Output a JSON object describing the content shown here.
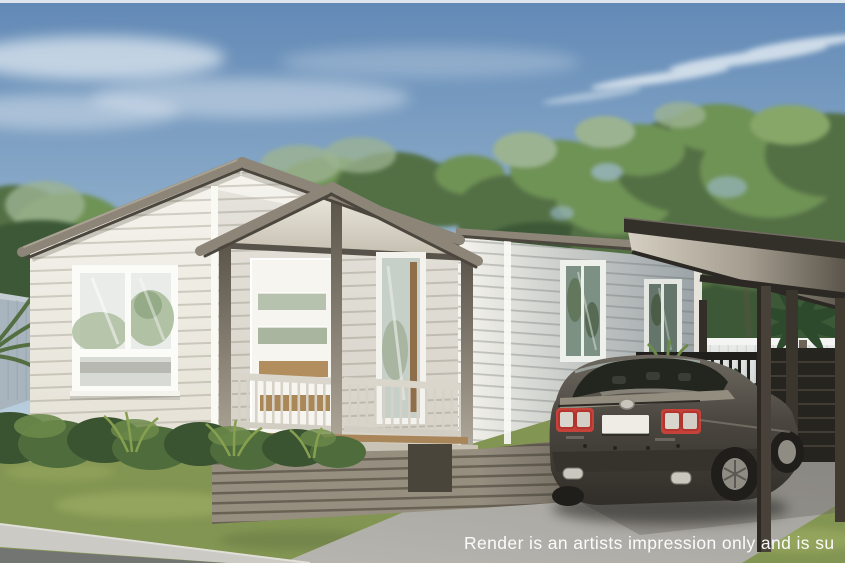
{
  "watermark": {
    "text": "Render is an artists impression only and is su"
  },
  "scene": {
    "subject": "single-storey weatherboard home render with gable porch, attached carport and parked grey sedan",
    "elements": [
      "sky",
      "eucalyptus-trees",
      "white-boundary-fence",
      "gable-roof",
      "front-porch",
      "front-door",
      "windows",
      "carport",
      "sedan-car",
      "lawn",
      "garden-shrubs",
      "driveway",
      "footpath",
      "road"
    ]
  },
  "palette": {
    "sky_top": "#6289b6",
    "sky_mid": "#9fbcd2",
    "sky_horizon": "#dce8ee",
    "cloud": "#e6eef4",
    "tree_dark": "#3c5836",
    "tree_mid": "#537045",
    "tree_light": "#6f9255",
    "tree_highlight": "#87a768",
    "tree_haze": "#9cb391",
    "trunk": "#5f5444",
    "roof": "#8d8678",
    "roof_light": "#aaa394",
    "roof_shadow": "#4c473e",
    "carport_fascia": "#33302a",
    "carport_soffit_light": "#d5cfc2",
    "carport_soffit_dark": "#5b554b",
    "carport_beam": "#2c2925",
    "siding": "#f6f4ee",
    "siding_shade": "#e4e0d5",
    "siding_far": "#9aa2a7",
    "trim": "#fafaf5",
    "gable_soffit_light": "#ece8dd",
    "gable_soffit_dark": "#c2bcae",
    "glass_light": "#e9ece9",
    "glass_mid": "#c7cfc9",
    "glass_far": "#7d9084",
    "reflection_green": "#aebfa0",
    "door": "#f7f5ef",
    "timber": "#b28e5e",
    "post_dark": "#5a544a",
    "post_light": "#b0a899",
    "railing": "#dad6cb",
    "baluster": "#d6d2c7",
    "deck": "#a9855a",
    "deck_fascia": "#c9c3b6",
    "skirting": "#968e7f",
    "skirting_dark": "#7d766a",
    "fence_white": "#eceeec",
    "fence_left": "#a9b5be",
    "lawn": "#839552",
    "lawn_light": "#a3b468",
    "lawn_dark": "#5e7140",
    "shrub_dark": "#3a5331",
    "shrub_mid": "#4f6c3c",
    "shrub_light": "#6c8a4a",
    "palm": "#2e4a2d",
    "driveway": "#b7b5af",
    "driveway_far": "#a19f99",
    "shade": "#6b6a65",
    "sidewalk": "#cbcac4",
    "road": "#737573",
    "car_top": "#6e6960",
    "car_mid": "#4a463f",
    "car_low": "#312e29",
    "car_glass": "#23261f",
    "car_interior": "#8b867c",
    "car_trunk": "#938d80",
    "tail_red": "#c5423a",
    "tail_inner": "#d9d6ce",
    "plate": "#eeece5",
    "chrome": "#cac7bf",
    "wheel": "#1f1e1b",
    "alloy": "#8f8c84",
    "rail_black": "#201f1c",
    "screen": "#26241f",
    "watermark": "#ffffff"
  }
}
